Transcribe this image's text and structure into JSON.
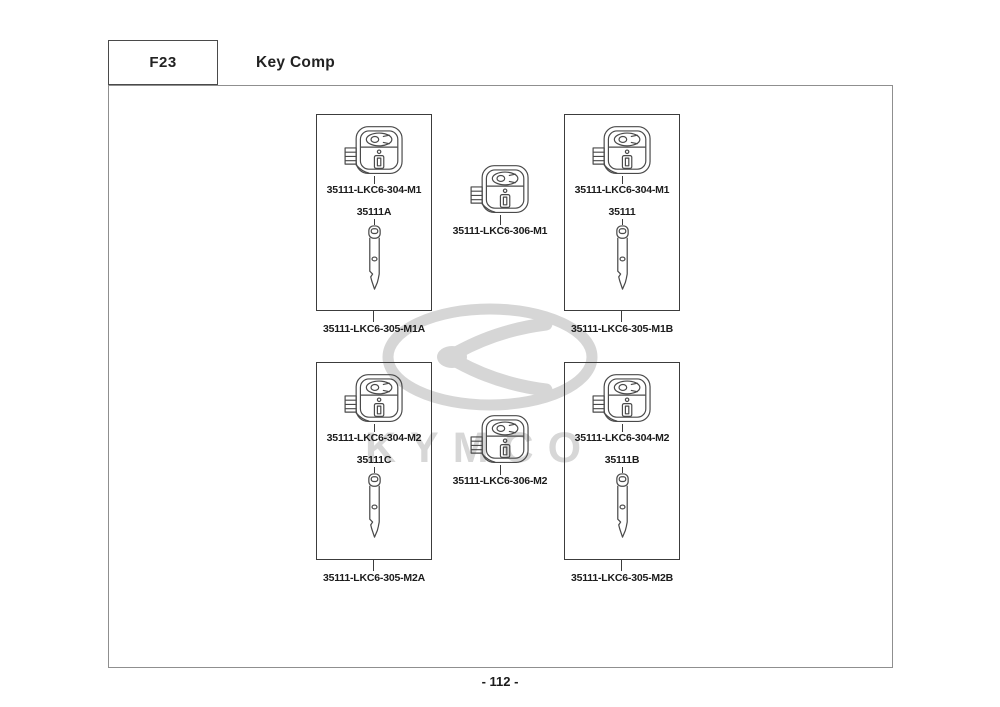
{
  "header": {
    "section_code": "F23",
    "title": "Key Comp"
  },
  "watermark": {
    "brand": "KYMCO"
  },
  "footer": {
    "page_number": "- 112 -"
  },
  "kits": {
    "m1a": {
      "head_part": "35111-LKC6-304-M1",
      "blade_label": "35111A",
      "kit_part": "35111-LKC6-305-M1A"
    },
    "m1b": {
      "head_part": "35111-LKC6-304-M1",
      "blade_label": "35111",
      "kit_part": "35111-LKC6-305-M1B"
    },
    "m2a": {
      "head_part": "35111-LKC6-304-M2",
      "blade_label": "35111C",
      "kit_part": "35111-LKC6-305-M2A"
    },
    "m2b": {
      "head_part": "35111-LKC6-304-M2",
      "blade_label": "35111B",
      "kit_part": "35111-LKC6-305-M2B"
    },
    "mid_m1": {
      "part": "35111-LKC6-306-M1"
    },
    "mid_m2": {
      "part": "35111-LKC6-306-M2"
    }
  }
}
